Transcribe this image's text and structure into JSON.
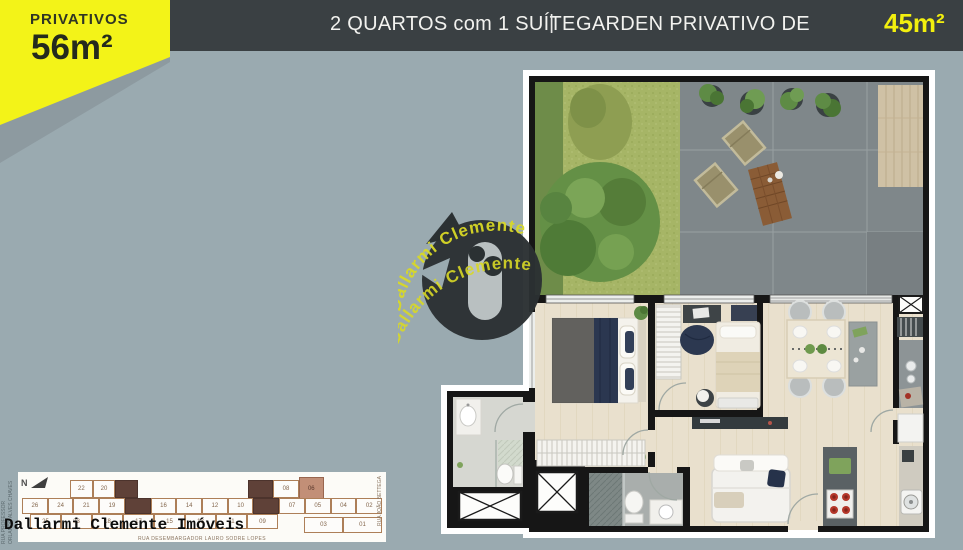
{
  "badge": {
    "label": "PRIVATIVOS",
    "area": "56m²"
  },
  "top_bar": {
    "left_title": "2 QUARTOS com 1 SUÍTE",
    "separator": "|",
    "right_title": "GARDEN PRIVATIVO DE",
    "right_area": "45m²"
  },
  "watermark": {
    "brand": "Dallarmi Clemente"
  },
  "agency": {
    "name": "Dallarmi Clemente Imóveis"
  },
  "site_plan": {
    "compass": "N",
    "streets": {
      "left_line1": "RUA PROFESSOR",
      "left_line2": "ORLANDO ALVES CHAVES",
      "right": "RUA JOÃO BETTEGA",
      "bottom": "RUA DESEMBARGADOR LAURO SODRE LOPES"
    },
    "top_left_row": [
      "22",
      "20"
    ],
    "top_right_row": [
      "08",
      "06"
    ],
    "middle_row": [
      "26",
      "24",
      "21",
      "19",
      "16",
      "14",
      "12",
      "10",
      "07",
      "05",
      "04",
      "02"
    ],
    "bottom_row": [
      "25",
      "23",
      "18",
      "17",
      "15",
      "13",
      "11",
      "09",
      "03",
      "01"
    ],
    "highlighted_unit": "06"
  },
  "colors": {
    "background": "#9aaab0",
    "top_bar_bg": "#3a4043",
    "accent_yellow": "#f3f318",
    "area_value_yellow": "#f2ef0e",
    "plan_wall": "#161616",
    "highlight_unit": "#c28f77",
    "watermark_text": "#d9d926"
  }
}
